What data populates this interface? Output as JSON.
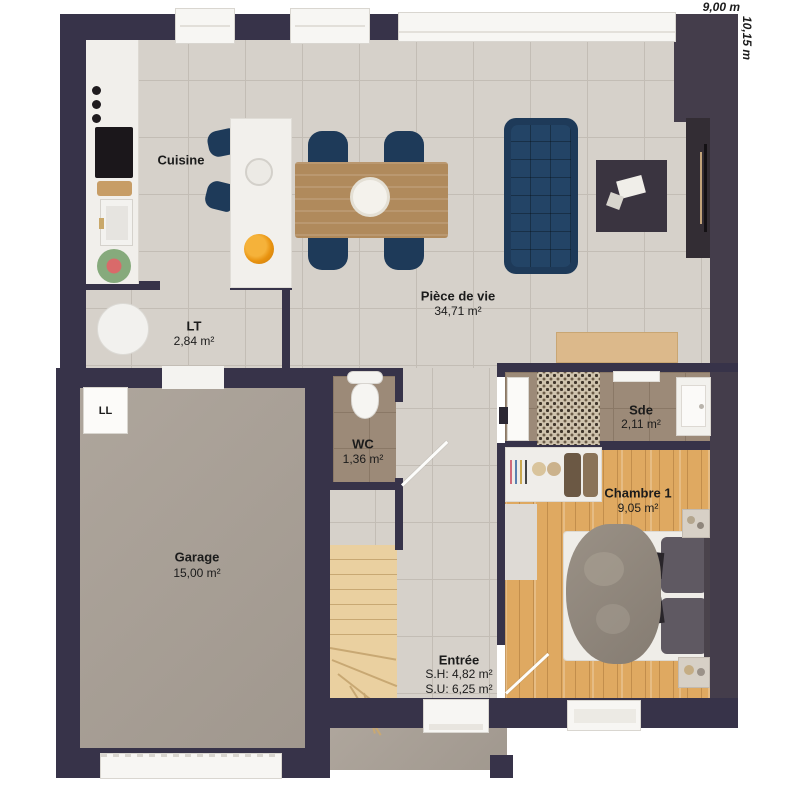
{
  "plan": {
    "dimensions": {
      "width": "9,00 m",
      "height": "10,15 m"
    },
    "rooms": {
      "cuisine": {
        "name": "Cuisine"
      },
      "piece_de_vie": {
        "name": "Pièce de vie",
        "area": "34,71 m²"
      },
      "lt": {
        "name": "LT",
        "area": "2,84 m²"
      },
      "wc": {
        "name": "WC",
        "area": "1,36 m²"
      },
      "garage": {
        "name": "Garage",
        "area": "15,00 m²"
      },
      "sde": {
        "name": "Sde",
        "area": "2,11 m²"
      },
      "chambre_1": {
        "name": "Chambre 1",
        "area": "9,05 m²"
      },
      "entree": {
        "name": "Entrée",
        "line1": "S.H: 4,82 m²",
        "line2": "S.U: 6,25 m²"
      }
    },
    "appliances": {
      "washing_machine_label": "LL"
    },
    "colors": {
      "wall": "#373349",
      "navy_furniture": "#1e3a59",
      "tile_floor": "#d6d1ca",
      "wood_floor": "#dfa961",
      "garage_floor": "#a9a096",
      "wet_room_floor": "#9c8a78"
    }
  }
}
